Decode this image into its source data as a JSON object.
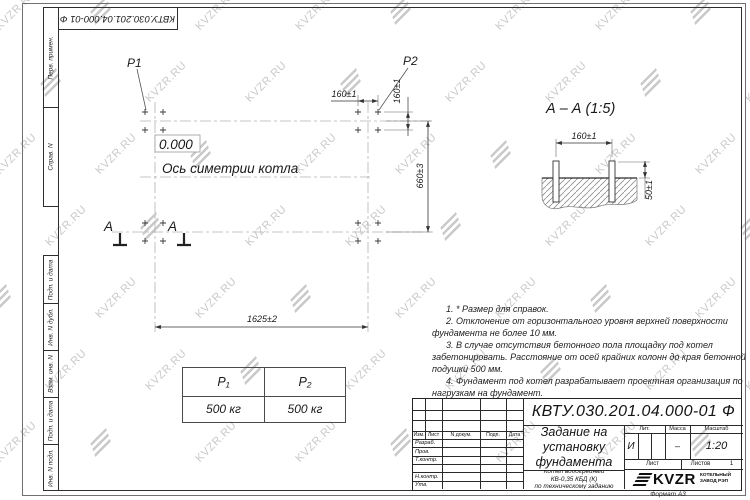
{
  "watermark": {
    "text": "KVZR.RU"
  },
  "frame": {
    "corner_number": "КВТУ.030.201.04.000-01 Ф",
    "format_label": "Формат А3",
    "margin_top": [
      "Перв. примен.",
      "Справ. N"
    ],
    "margin_bottom": [
      "Подп. и дата",
      "Инв. N дубл.",
      "Взам. инв. N",
      "Подп. и дата",
      "Инв. N подл."
    ]
  },
  "plan": {
    "load1_label": "P1",
    "load2_label": "P2",
    "level_mark": "0.000",
    "axis_label": "Ось симетрии котла",
    "section_letter": "A",
    "dims": {
      "width": "1625±2",
      "depth": "660±3",
      "bolt_spacing_x": "160±1",
      "bolt_spacing_y": "160±1"
    }
  },
  "section_view": {
    "title": "А – А (1:5)",
    "dims": {
      "bolt_spacing": "160±1",
      "bolt_height": "50±1"
    }
  },
  "notes": [
    "1. * Размер для справок.",
    "2. Отклонение от горизонтального уровня верхней поверхности фундамента не более 10 мм.",
    "3. В случае отсутствия бетонного пола площадку под котел забетонировать. Расстояние от осей крайних колонн до края бетонной подушки 500 мм.",
    "4. Фундамент под котел разрабатывает проектная организация по нагрузкам на фундамент."
  ],
  "loads_table": {
    "headers": [
      "P₁",
      "P₂"
    ],
    "values": [
      "500 кг",
      "500 кг"
    ]
  },
  "title_block": {
    "doc_number": "КВТУ.030.201.04.000-01 Ф",
    "doc_title": "Задание на\nустановку\nфундамента",
    "doc_subtitle": "Котел водогрейный\nКВ-0,35 КБД (К)\nпо техническому заданию",
    "header_cols": [
      "Изм.",
      "Лист",
      "N докум.",
      "Подп.",
      "Дата"
    ],
    "row_labels": [
      "Разраб.",
      "Пров.",
      "Т.контр.",
      "",
      "Н.контр.",
      "Утв."
    ],
    "lit_label": "Лит.",
    "lit_value": "И",
    "mass_label": "Масса",
    "mass_value": "–",
    "scale_label": "Масштаб",
    "scale_value": "1:20",
    "sheet_label": "Лист",
    "sheets_label": "Листов",
    "sheets_value": "1",
    "company_name": "KVZR",
    "company_desc": "КОТЕЛЬНЫЙ\nЗАВОД РЭП"
  }
}
